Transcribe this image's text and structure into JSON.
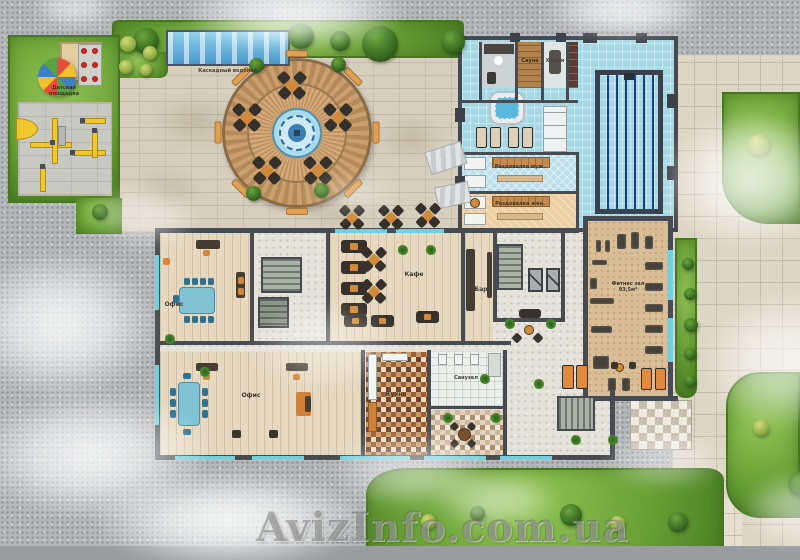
{
  "watermark": "AvizInfo.com.ua",
  "labels": {
    "playground": "Детская площадка",
    "waterfall": "Каскадный водопад",
    "sauna": "Сауна",
    "hammam": "Хамам",
    "changing_men": "Раздевалка муж.",
    "changing_women": "Раздевалка жен.",
    "office_top": "Офис",
    "office_bottom": "Офис",
    "cafe": "Кафе",
    "bar": "Бар",
    "kitchen": "Кухня",
    "wc": "Санузел",
    "fitness_name": "Фитнес зал",
    "fitness_area": "93,5м²"
  },
  "colors": {
    "background_gravel": "#b4b7b9",
    "grass": "#68a035",
    "paving": "#d7cfbe",
    "spa_floor": "#a5d8e4",
    "pool_water": "#2b7cc9",
    "terrace_wood": "#c09468",
    "accent_orange": "#d8853c",
    "wall": "#474c52",
    "window_glass": "#70d2de"
  }
}
